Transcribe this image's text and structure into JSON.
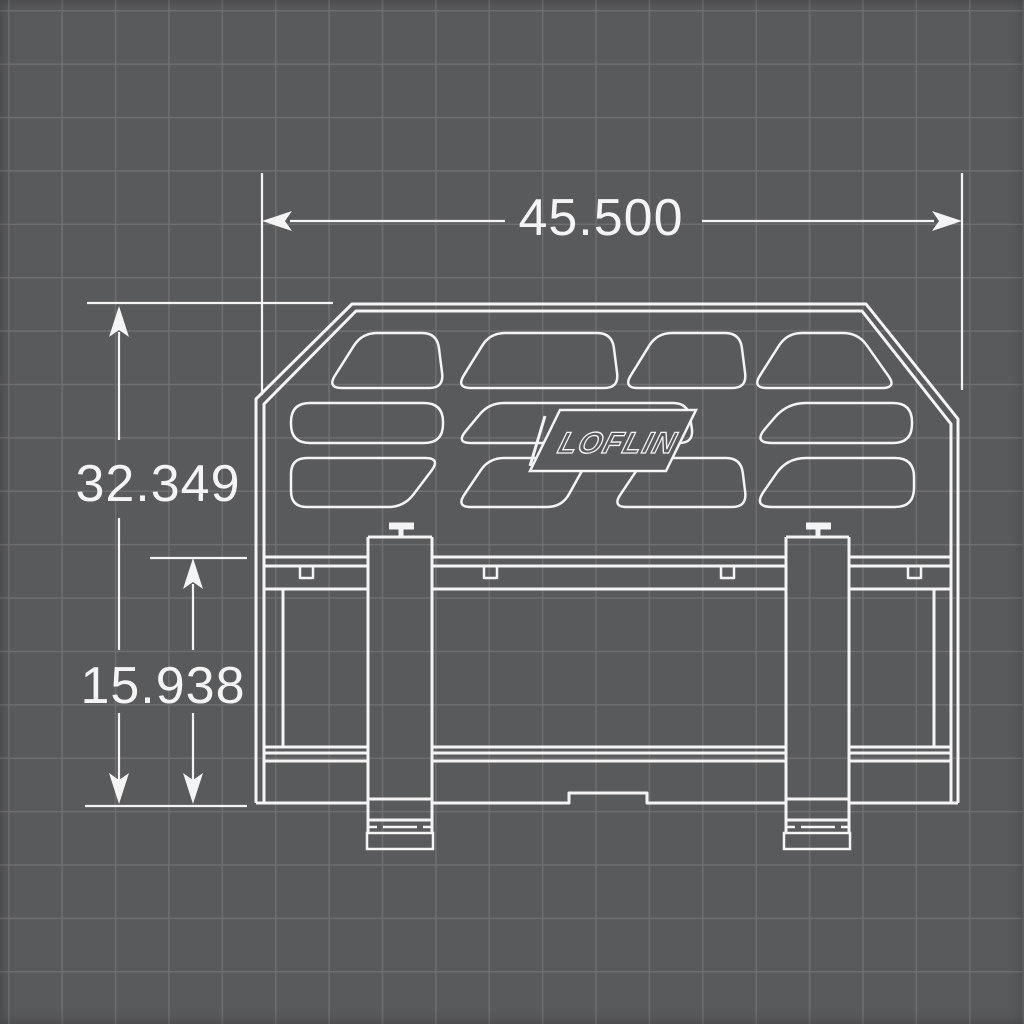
{
  "dimensions": {
    "top_width": "45.500",
    "left_total_height": "32.349",
    "left_lower_height": "15.938"
  },
  "logo": {
    "text": "LOFLIN"
  },
  "colors": {
    "background": "#595a5c",
    "grid_line": "#6e6f71",
    "line": "#f4f4f4",
    "text": "#f4f4f4"
  }
}
